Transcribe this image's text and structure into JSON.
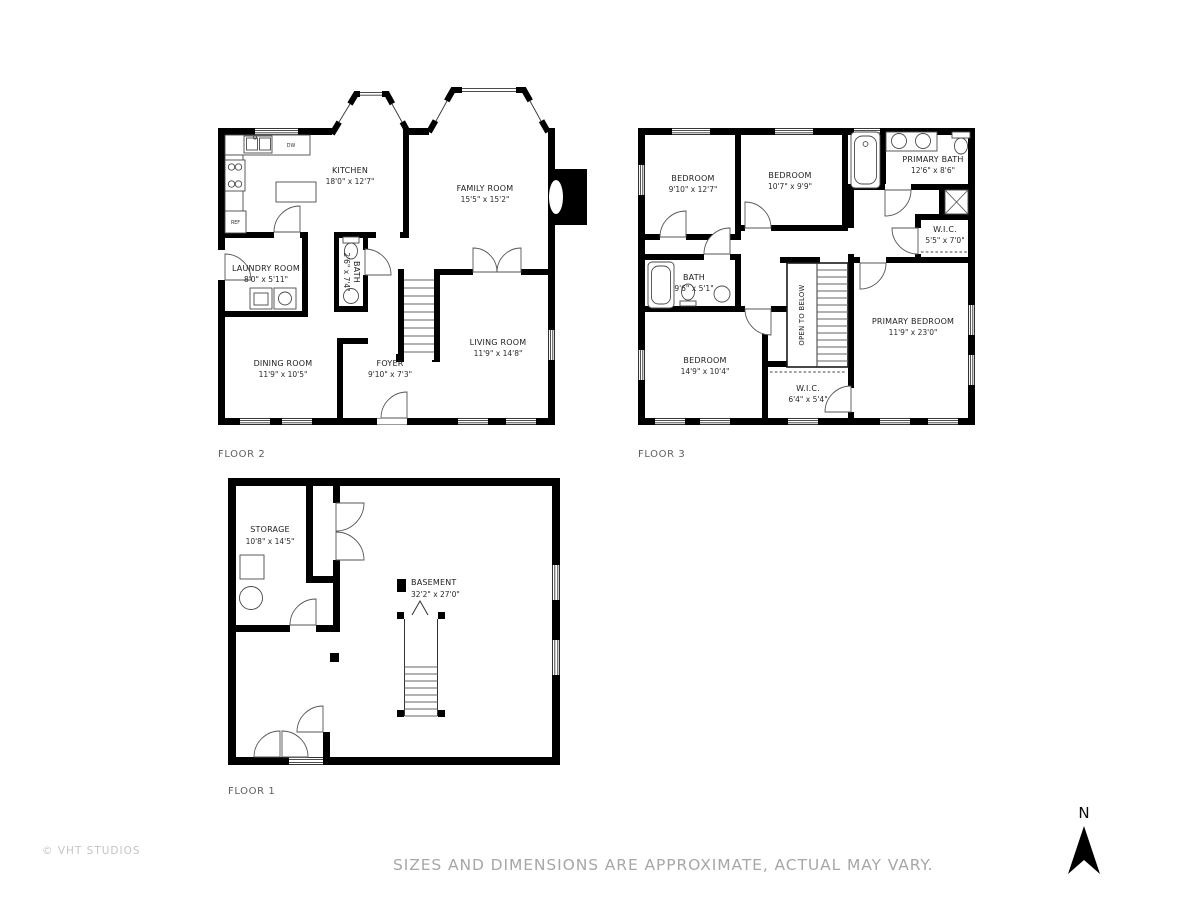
{
  "page": {
    "background": "#ffffff",
    "wall_color": "#000000",
    "footer": {
      "copyright": "© VHT STUDIOS",
      "disclaimer": "SIZES AND DIMENSIONS ARE APPROXIMATE, ACTUAL MAY VARY."
    },
    "compass": {
      "label": "N"
    }
  },
  "floors": [
    {
      "label": "FLOOR 2",
      "rooms": [
        {
          "name": "KITCHEN",
          "dims": "18'0\" x 12'7\""
        },
        {
          "name": "FAMILY ROOM",
          "dims": "15'5\" x 15'2\""
        },
        {
          "name": "LAUNDRY ROOM",
          "dims": "8'0\" x 5'11\""
        },
        {
          "name": "BATH",
          "dims": "2'6\" x 7'4\""
        },
        {
          "name": "DINING ROOM",
          "dims": "11'9\" x 10'5\""
        },
        {
          "name": "FOYER",
          "dims": "9'10\" x 7'3\""
        },
        {
          "name": "LIVING ROOM",
          "dims": "11'9\" x 14'8\""
        }
      ],
      "appliances": {
        "dishwasher": "DW",
        "refrigerator": "REF"
      }
    },
    {
      "label": "FLOOR 3",
      "rooms": [
        {
          "name": "BEDROOM",
          "dims": "9'10\" x 12'7\""
        },
        {
          "name": "BEDROOM",
          "dims": "10'7\" x 9'9\""
        },
        {
          "name": "PRIMARY BATH",
          "dims": "12'6\" x 8'6\""
        },
        {
          "name": "W.I.C.",
          "dims": "5'5\" x 7'0\""
        },
        {
          "name": "BATH",
          "dims": "9'6\" x 5'1\""
        },
        {
          "name": "BEDROOM",
          "dims": "14'9\" x 10'4\""
        },
        {
          "name": "W.I.C.",
          "dims": "6'4\" x 5'4\""
        },
        {
          "name": "PRIMARY BEDROOM",
          "dims": "11'9\" x 23'0\""
        }
      ],
      "annotations": {
        "open_to_below": "OPEN TO BELOW"
      }
    },
    {
      "label": "FLOOR 1",
      "rooms": [
        {
          "name": "STORAGE",
          "dims": "10'8\" x 14'5\""
        },
        {
          "name": "BASEMENT",
          "dims": "32'2\" x 27'0\""
        }
      ]
    }
  ]
}
